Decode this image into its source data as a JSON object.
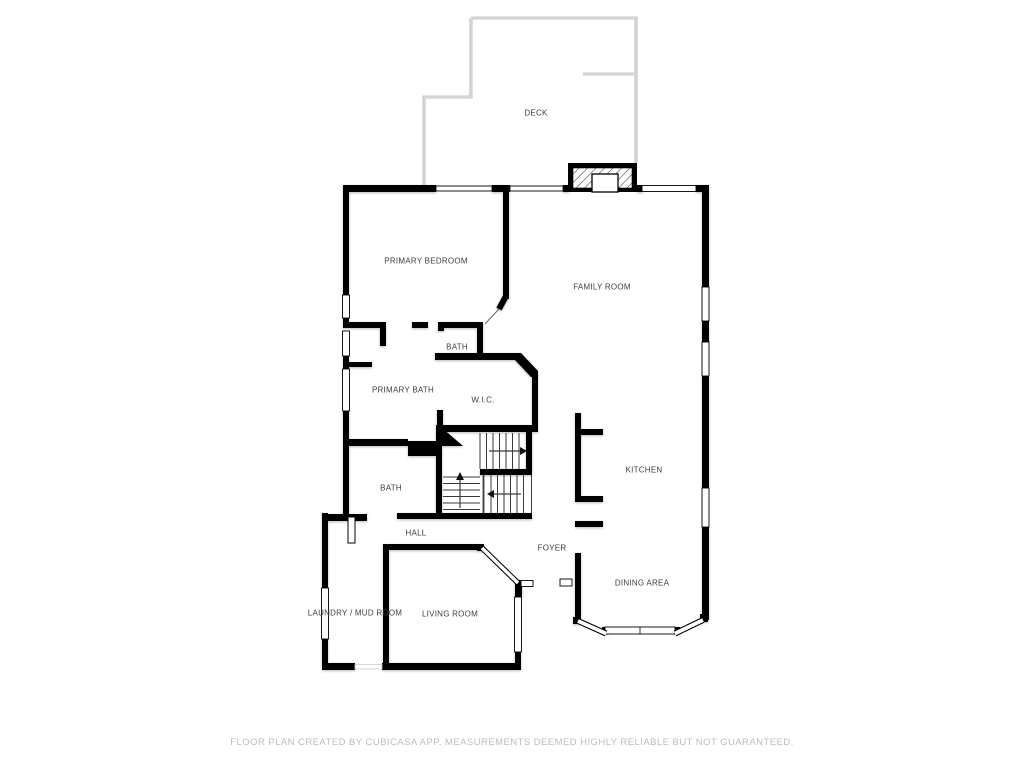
{
  "colors": {
    "wall": "#000000",
    "label_text": "#3d3d3d",
    "deck_outline": "#8f8f8f",
    "disclaimer_text": "#bcbcbc",
    "background": "#ffffff"
  },
  "floor_plan": {
    "rooms": [
      {
        "id": "deck",
        "label": "DECK"
      },
      {
        "id": "primary-bedroom",
        "label": "PRIMARY BEDROOM"
      },
      {
        "id": "family-room",
        "label": "FAMILY ROOM"
      },
      {
        "id": "bath-water-closet",
        "label": "BATH"
      },
      {
        "id": "primary-bath",
        "label": "PRIMARY BATH"
      },
      {
        "id": "walk-in-closet",
        "label": "W.I.C."
      },
      {
        "id": "bath",
        "label": "BATH"
      },
      {
        "id": "hall",
        "label": "HALL"
      },
      {
        "id": "kitchen",
        "label": "KITCHEN"
      },
      {
        "id": "foyer",
        "label": "FOYER"
      },
      {
        "id": "laundry-mud-room",
        "label": "LAUNDRY / MUD ROOM"
      },
      {
        "id": "living-room",
        "label": "LIVING ROOM"
      },
      {
        "id": "dining-area",
        "label": "DINING AREA"
      }
    ]
  },
  "footer": {
    "disclaimer": "FLOOR PLAN CREATED BY CUBICASA APP. MEASUREMENTS DEEMED HIGHLY RELIABLE BUT NOT GUARANTEED."
  }
}
